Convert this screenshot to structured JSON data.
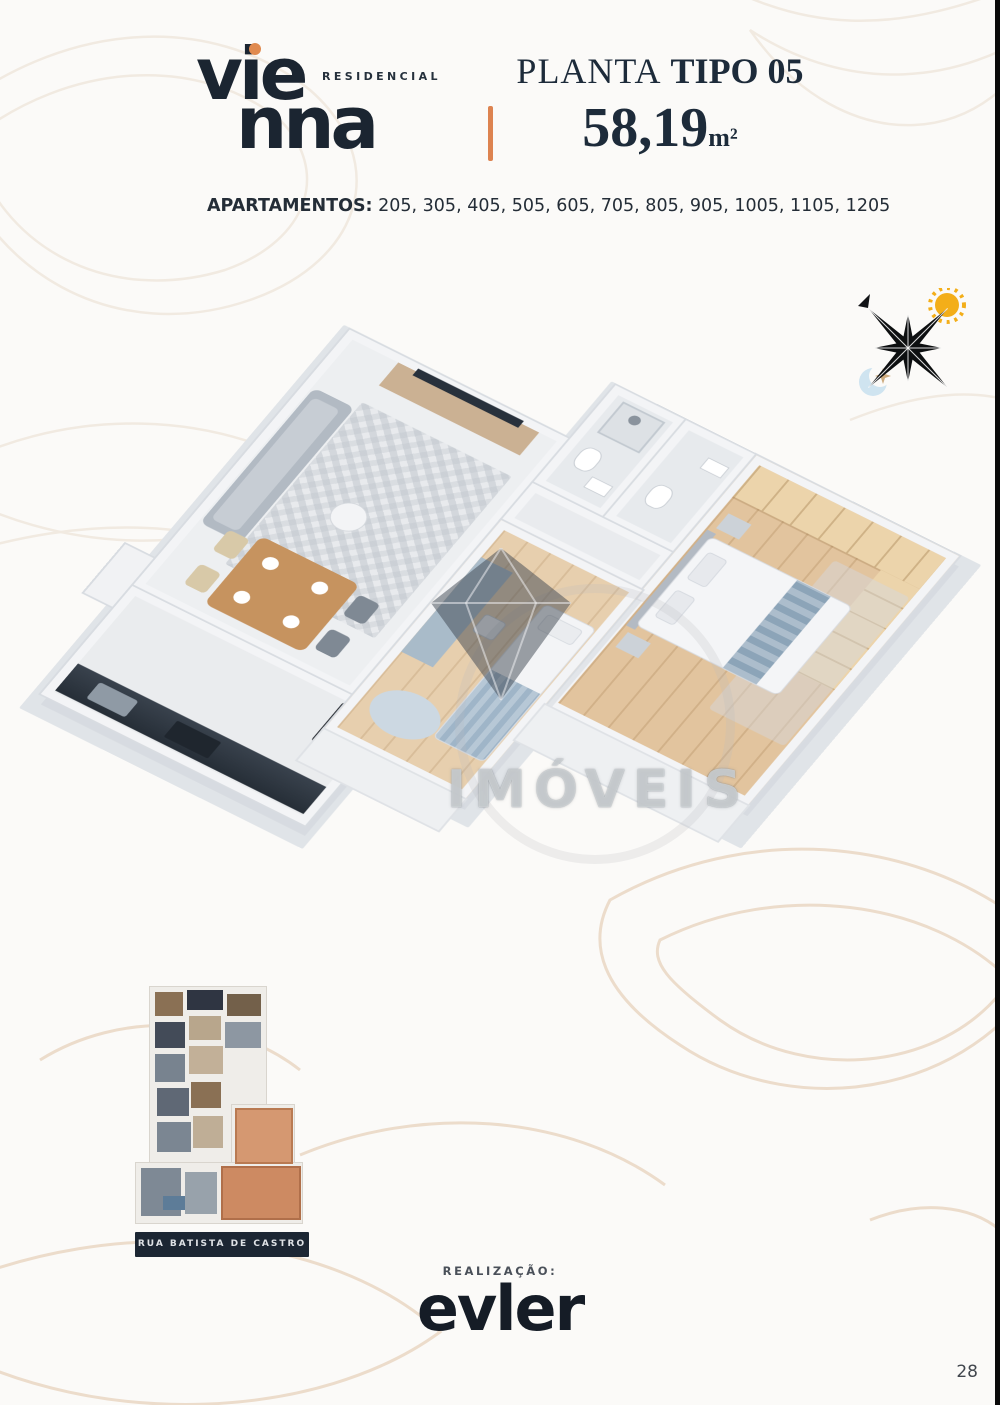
{
  "page": {
    "number": "28"
  },
  "colors": {
    "navy": "#1c2836",
    "accent_orange": "#dd8350",
    "highlight_unit": "#d59871",
    "watermark_gray": "#c9ccd1",
    "background": "#fbfaf8"
  },
  "header": {
    "logo": {
      "line1": "vie",
      "line2": "nna",
      "subtitle": "RESIDENCIAL"
    },
    "title": {
      "regular": "PLANTA",
      "bold": "TIPO 05",
      "area_value": "58,19",
      "area_unit": "m²"
    },
    "apartments": {
      "label": "APARTAMENTOS:",
      "numbers": "205, 305, 405, 505, 605, 705, 805, 905, 1005, 1105, 1205"
    }
  },
  "floorplan": {
    "watermark": {
      "text": "IMÓVEIS"
    }
  },
  "icons": {
    "compass_star": "eight-point-compass-star",
    "sun": "sun-icon",
    "moon": "crescent-moon-icon",
    "north_arrow": "north-arrow-icon",
    "watermark_logo": "diamond-gem-icon"
  },
  "keyplan": {
    "street_label": "RUA BATISTA DE CASTRO"
  },
  "footer": {
    "realization_label": "REALIZAÇÃO:",
    "brand": "evler"
  }
}
